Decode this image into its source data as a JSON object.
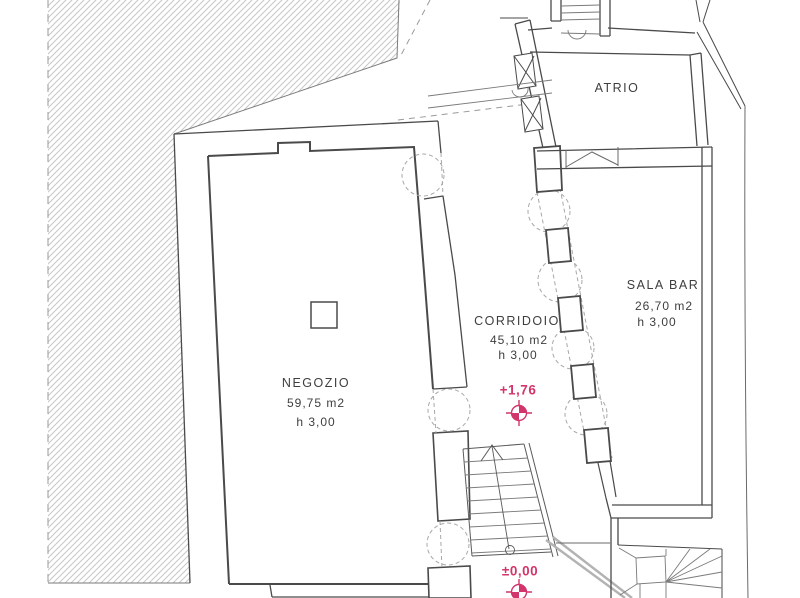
{
  "drawing_type": "architectural floor plan",
  "colors": {
    "line": "#4a4a4a",
    "thin_line": "#6a6a6a",
    "hatch": "#c7c7c7",
    "accent": "#d2356b"
  },
  "rooms": {
    "atrio": {
      "name": "ATRIO"
    },
    "negozio": {
      "name": "NEGOZIO",
      "area": "59,75 m2",
      "height": "h 3,00"
    },
    "corridoio": {
      "name": "CORRIDOIO",
      "area": "45,10 m2",
      "height": "h 3,00"
    },
    "sala_bar": {
      "name": "SALA BAR",
      "area": "26,70 m2",
      "height": "h 3,00"
    }
  },
  "level_markers": [
    {
      "label": "+1,76",
      "symbol": "survey-cross"
    },
    {
      "label": "±0,00",
      "symbol": "survey-cross"
    }
  ]
}
